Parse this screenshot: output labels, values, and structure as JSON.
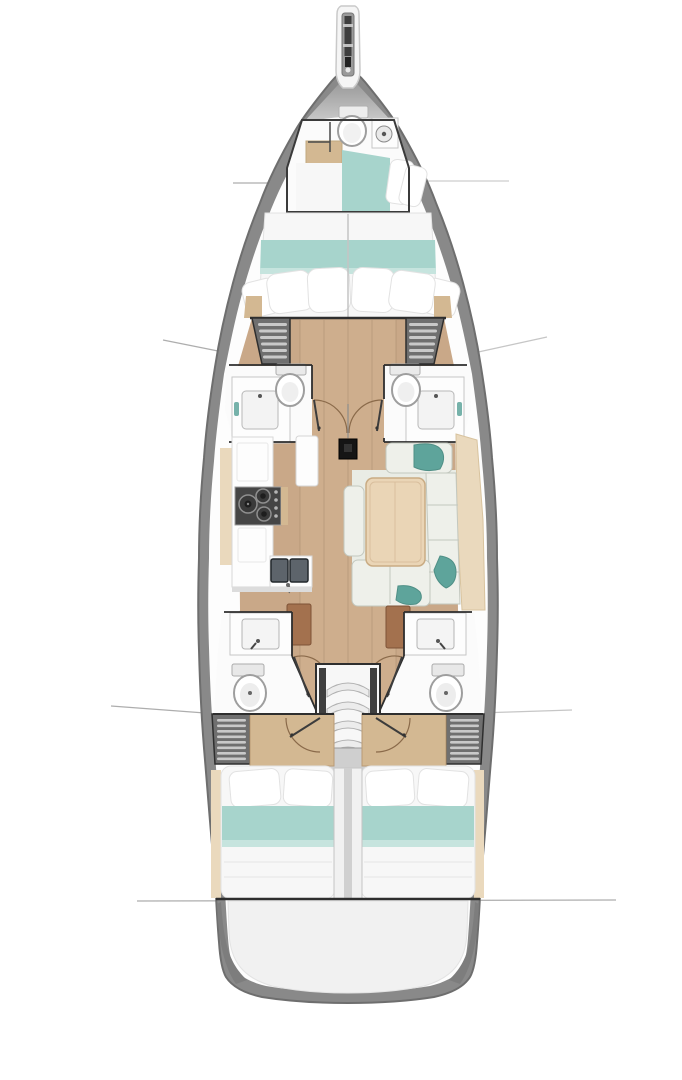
{
  "page": {
    "kind": "yacht-interior-floor-plan",
    "orientation": "bow-up",
    "visible_text": ""
  },
  "colors": {
    "background": "#ffffff",
    "hull": "#898989",
    "hull_edge": "#6e6e6e",
    "deck": "#fdfdfd",
    "bow_top": "#8f8f8f",
    "bow_bottom": "#cdcdcd",
    "wall": "#2e2e2e",
    "wood": "#c9a888",
    "wood_light": "#d8bb98",
    "wood_seam": "#8a6f55",
    "headboard": "#d3b892",
    "table": "#ead5b6",
    "table_edge": "#c9ab83",
    "bed": "#f7f7f7",
    "bed_edge": "#e2e2e2",
    "teal": "#a7d4cc",
    "teal_light": "#c6e4de",
    "accent_teal": "#5ea49b",
    "locker": "#6f6f6f",
    "locker_slat": "#c9c9c9",
    "fixture": "#fdfdfd",
    "fixture_edge": "#c6c6c6",
    "porcelain": "#ffffff",
    "porcelain_edge": "#9e9e9e",
    "stove": "#454545",
    "stove_edge": "#9f9f9f",
    "sink_steel": "#5d646b",
    "settee": "#eef0ea",
    "settee_seam": "#c3c8bf",
    "rug": "#e9ece5",
    "panel_brown": "#a3714e",
    "transom": "#f1f1f1",
    "step": "#ececec",
    "step_edge": "#b0b0b0",
    "landing": "#cfcfcf",
    "divider": "#f1f1f1",
    "divider_seam": "#d0d0d0",
    "rail": "#3f3f3f",
    "leader": "#9f9f9f",
    "door_arc": "#8a6a4a",
    "door_leaf": "#3c3c3c",
    "shelf_beige": "#ead9bd",
    "floor_white": "#fbfbfb",
    "mast": "#151515"
  },
  "features": {
    "hull": "Sailboat hull top view",
    "bowsprit": "Bowsprit with anchor roller",
    "forepeak": "Forepeak compartment with head and crew berth",
    "forepeak_head": "Forepeak toilet and washbasin",
    "owner_cabin": "Forward owner cabin with double berth and pillows",
    "port_forward_wardrobe": "Port forward louvered wardrobe",
    "starboard_forward_wardrobe": "Starboard forward louvered wardrobe",
    "port_forward_head": "Port forward head with toilet and washbasin",
    "starboard_forward_head": "Starboard forward head with toilet and washbasin",
    "mast": "Mast post",
    "galley": "Port galley with stove and double sink",
    "salon": "Starboard salon with table and U-settee",
    "port_aft_head": "Port aft head with toilet and washbasin",
    "starboard_aft_head": "Starboard aft head with toilet and washbasin",
    "companionway": "Companionway steps",
    "port_aft_wardrobe": "Port aft louvered wardrobe",
    "starboard_aft_wardrobe": "Starboard aft louvered wardrobe",
    "port_aft_cabin": "Port aft cabin with double berth",
    "starboard_aft_cabin": "Starboard aft cabin with double berth",
    "transom": "Rounded stern platform",
    "leader_lines": "Section leader lines",
    "corridor": "Central wood cabin sole"
  }
}
